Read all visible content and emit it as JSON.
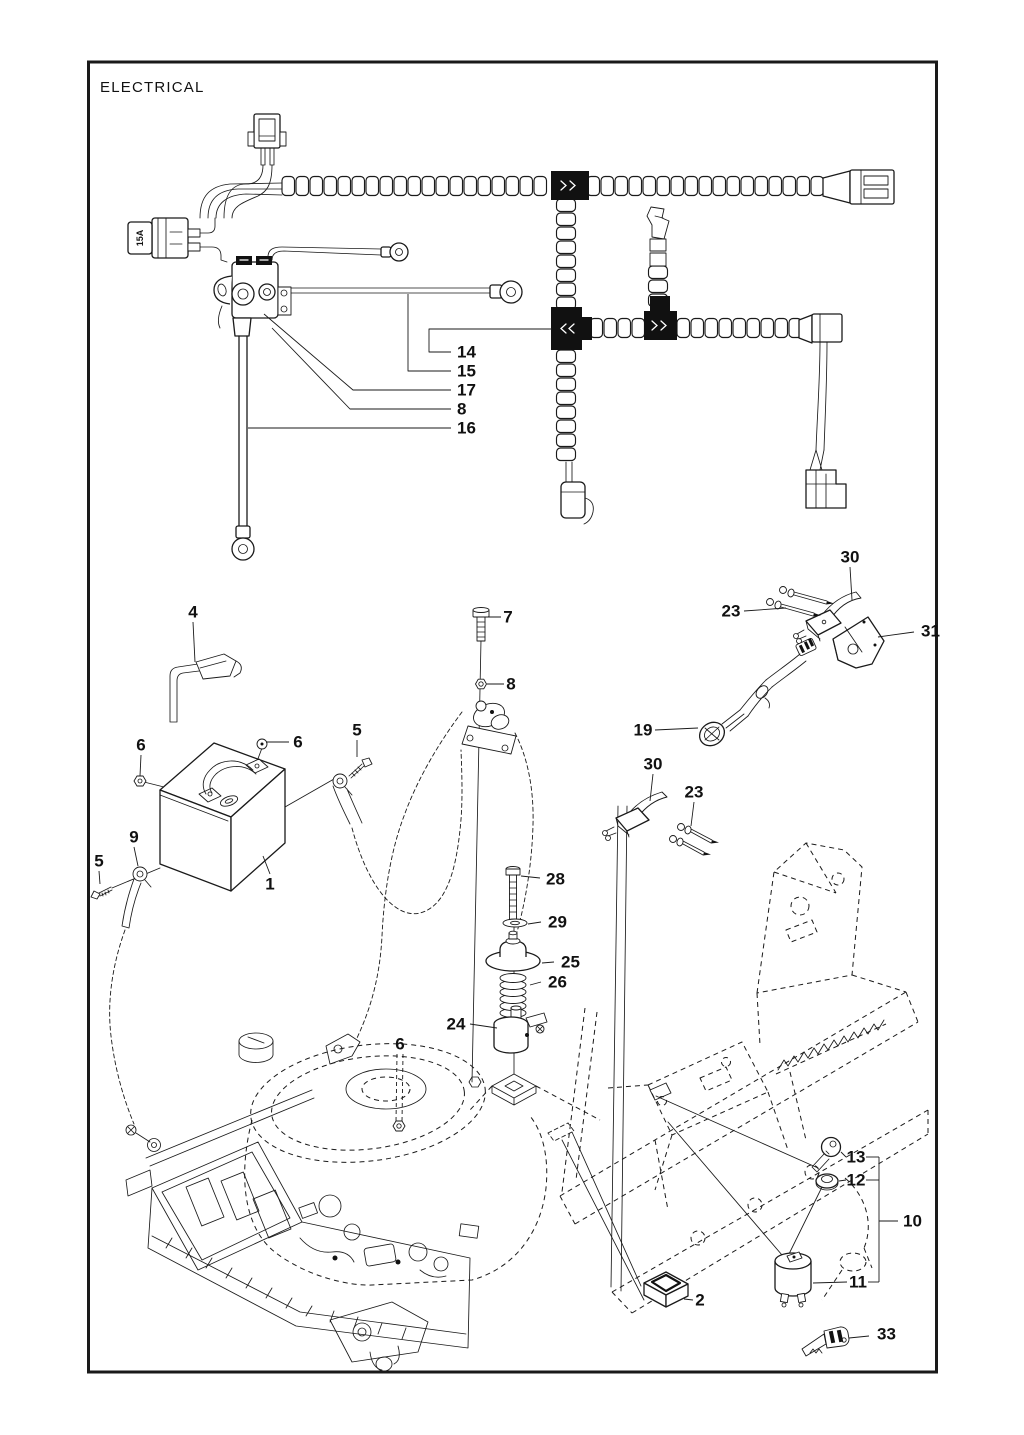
{
  "title": "ELECTRICAL",
  "fuse_label": "15A",
  "colors": {
    "line": "#1a1a1a",
    "background": "#ffffff"
  },
  "callouts": [
    {
      "label": "14",
      "x": 457,
      "y": 352,
      "anchor": "start",
      "leader": [
        [
          451,
          352
        ],
        [
          429,
          352
        ],
        [
          429,
          329
        ],
        [
          552,
          329
        ]
      ]
    },
    {
      "label": "15",
      "x": 457,
      "y": 371,
      "anchor": "start",
      "leader": [
        [
          451,
          371
        ],
        [
          408,
          371
        ],
        [
          408,
          294
        ]
      ]
    },
    {
      "label": "17",
      "x": 457,
      "y": 390,
      "anchor": "start",
      "leader": [
        [
          451,
          390
        ],
        [
          353,
          390
        ],
        [
          264,
          314
        ]
      ]
    },
    {
      "label": "8",
      "x": 457,
      "y": 409,
      "anchor": "start",
      "leader": [
        [
          451,
          409
        ],
        [
          350,
          409
        ],
        [
          272,
          328
        ]
      ]
    },
    {
      "label": "16",
      "x": 457,
      "y": 428,
      "anchor": "start",
      "leader": [
        [
          451,
          428
        ],
        [
          248,
          428
        ]
      ]
    },
    {
      "label": "4",
      "x": 193,
      "y": 612,
      "leader": [
        [
          193,
          622
        ],
        [
          195,
          662
        ]
      ]
    },
    {
      "label": "7",
      "x": 508,
      "y": 617,
      "leader": [
        [
          501,
          617
        ],
        [
          484,
          617
        ]
      ]
    },
    {
      "label": "8",
      "x": 511,
      "y": 684,
      "leader": [
        [
          504,
          684
        ],
        [
          487,
          684
        ]
      ]
    },
    {
      "label": "30",
      "x": 850,
      "y": 557,
      "leader": [
        [
          850,
          567
        ],
        [
          852,
          600
        ]
      ]
    },
    {
      "label": "23",
      "x": 731,
      "y": 611,
      "leader": [
        [
          744,
          611
        ],
        [
          786,
          608
        ]
      ]
    },
    {
      "label": "31",
      "x": 921,
      "y": 631,
      "anchor": "start",
      "leader": [
        [
          914,
          632
        ],
        [
          878,
          637
        ]
      ]
    },
    {
      "label": "19",
      "x": 643,
      "y": 730,
      "leader": [
        [
          655,
          730
        ],
        [
          698,
          728
        ]
      ]
    },
    {
      "label": "30",
      "x": 653,
      "y": 764,
      "leader": [
        [
          653,
          774
        ],
        [
          650,
          801
        ]
      ]
    },
    {
      "label": "23",
      "x": 694,
      "y": 792,
      "leader": [
        [
          694,
          802
        ],
        [
          691,
          826
        ]
      ]
    },
    {
      "label": "6",
      "x": 141,
      "y": 745,
      "leader": [
        [
          141,
          755
        ],
        [
          140,
          776
        ]
      ]
    },
    {
      "label": "6",
      "x": 298,
      "y": 742,
      "leader": [
        [
          289,
          742
        ],
        [
          266,
          742
        ]
      ]
    },
    {
      "label": "5",
      "x": 357,
      "y": 730,
      "leader": [
        [
          357,
          740
        ],
        [
          357,
          757
        ]
      ]
    },
    {
      "label": "9",
      "x": 134,
      "y": 837,
      "leader": [
        [
          134,
          847
        ],
        [
          138,
          866
        ]
      ]
    },
    {
      "label": "5",
      "x": 99,
      "y": 861,
      "leader": [
        [
          99,
          871
        ],
        [
          100,
          884
        ]
      ]
    },
    {
      "label": "1",
      "x": 270,
      "y": 884,
      "leader": [
        [
          270,
          874
        ],
        [
          263,
          856
        ]
      ]
    },
    {
      "label": "28",
      "x": 546,
      "y": 879,
      "anchor": "start",
      "leader": [
        [
          540,
          878
        ],
        [
          521,
          876
        ]
      ]
    },
    {
      "label": "29",
      "x": 548,
      "y": 922,
      "anchor": "start",
      "leader": [
        [
          541,
          922
        ],
        [
          528,
          924
        ]
      ]
    },
    {
      "label": "25",
      "x": 561,
      "y": 962,
      "anchor": "start",
      "leader": [
        [
          554,
          962
        ],
        [
          542,
          963
        ]
      ]
    },
    {
      "label": "26",
      "x": 548,
      "y": 982,
      "anchor": "start",
      "leader": [
        [
          541,
          982
        ],
        [
          530,
          985
        ]
      ]
    },
    {
      "label": "24",
      "x": 456,
      "y": 1024,
      "leader": [
        [
          470,
          1024
        ],
        [
          497,
          1028
        ]
      ]
    },
    {
      "label": "6",
      "x": 400,
      "y": 1044,
      "dashed": true,
      "leader": [
        [
          397,
          1054
        ],
        [
          396,
          1122
        ]
      ],
      "leader2": [
        [
          403,
          1054
        ],
        [
          402,
          1122
        ]
      ]
    },
    {
      "label": "13",
      "x": 856,
      "y": 1157,
      "leader": [
        [
          846,
          1157
        ],
        [
          841,
          1152
        ]
      ],
      "leader2": [
        [
          866,
          1157
        ],
        [
          879,
          1157
        ]
      ]
    },
    {
      "label": "12",
      "x": 856,
      "y": 1180,
      "leader": [
        [
          846,
          1180
        ],
        [
          839,
          1181
        ]
      ],
      "leader2": [
        [
          866,
          1180
        ],
        [
          879,
          1180
        ]
      ]
    },
    {
      "label": "10",
      "x": 903,
      "y": 1221,
      "anchor": "start",
      "leader": [
        [
          898,
          1221
        ],
        [
          879,
          1221
        ]
      ]
    },
    {
      "label": "11",
      "x": 858,
      "y": 1282,
      "leader": [
        [
          847,
          1282
        ],
        [
          813,
          1283
        ]
      ],
      "leader2": [
        [
          868,
          1282
        ],
        [
          879,
          1282
        ]
      ]
    },
    {
      "label": "2",
      "x": 700,
      "y": 1300,
      "leader": [
        [
          693,
          1300
        ],
        [
          684,
          1299
        ]
      ]
    },
    {
      "label": "33",
      "x": 877,
      "y": 1334,
      "anchor": "start",
      "leader": [
        [
          869,
          1336
        ],
        [
          849,
          1338
        ]
      ]
    }
  ],
  "extra_polylines": [
    {
      "points": [
        [
          879,
          1157
        ],
        [
          879,
          1282
        ]
      ]
    }
  ]
}
